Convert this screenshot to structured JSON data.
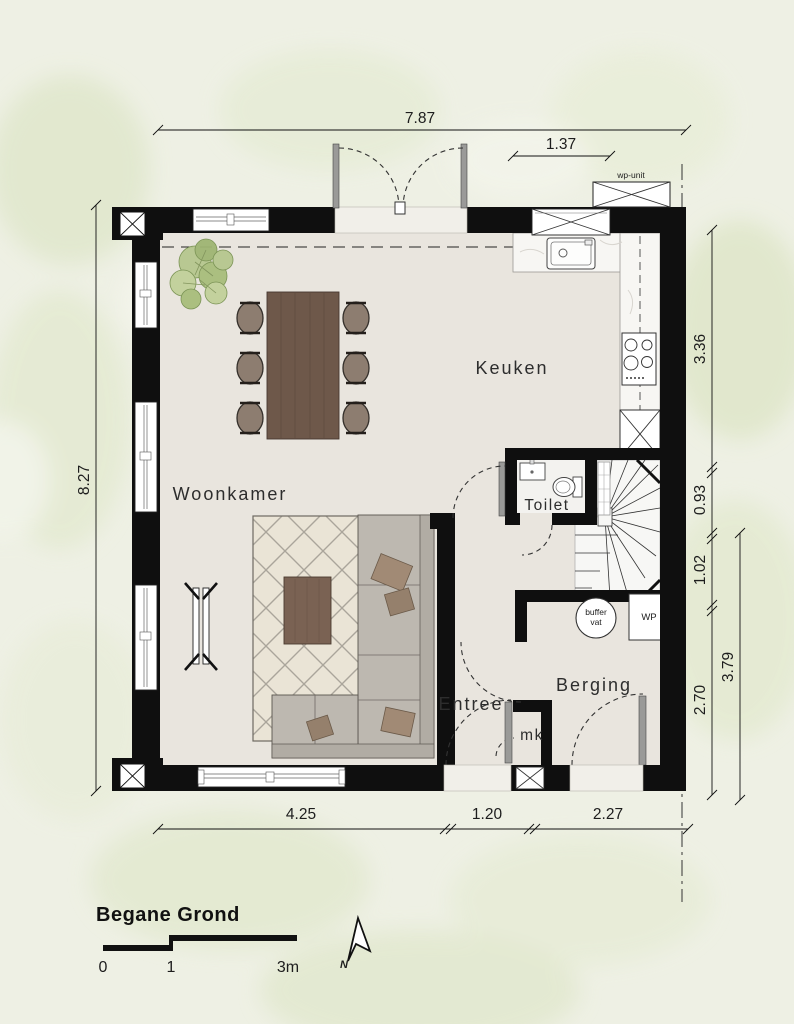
{
  "meta": {
    "drawing_title": "Begane Grond"
  },
  "rooms": {
    "woonkamer": "Woonkamer",
    "keuken": "Keuken",
    "toilet": "Toilet",
    "entree": "Entree",
    "berging": "Berging",
    "meterkast": "mk"
  },
  "equipment": {
    "wp_unit_label": "wp-unit",
    "buffer_vat_line1": "buffer",
    "buffer_vat_line2": "vat",
    "heat_pump": "WP"
  },
  "dimensions": {
    "top_total": "7.87",
    "top_kitchen_window": "1.37",
    "left_total": "8.27",
    "right_segments": {
      "kitchen": "3.36",
      "toilet": "0.93",
      "stairs": "1.02",
      "berging": "2.70",
      "lower_total": "3.79"
    },
    "bottom_segments": {
      "woonkamer": "4.25",
      "entree": "1.20",
      "berging": "2.27"
    }
  },
  "legend": {
    "floor_name": "Begane Grond",
    "scale_start": "0",
    "scale_mid": "1",
    "scale_end": "3m",
    "north": "N"
  },
  "colors": {
    "wall": "#0f0f0f",
    "floor": "#e9e5de",
    "background": "#eef0e4",
    "marble": "#f7f6f3",
    "wood": "#6e584a",
    "sofa": "#bdb8b0",
    "plant": "#b6c78e"
  }
}
